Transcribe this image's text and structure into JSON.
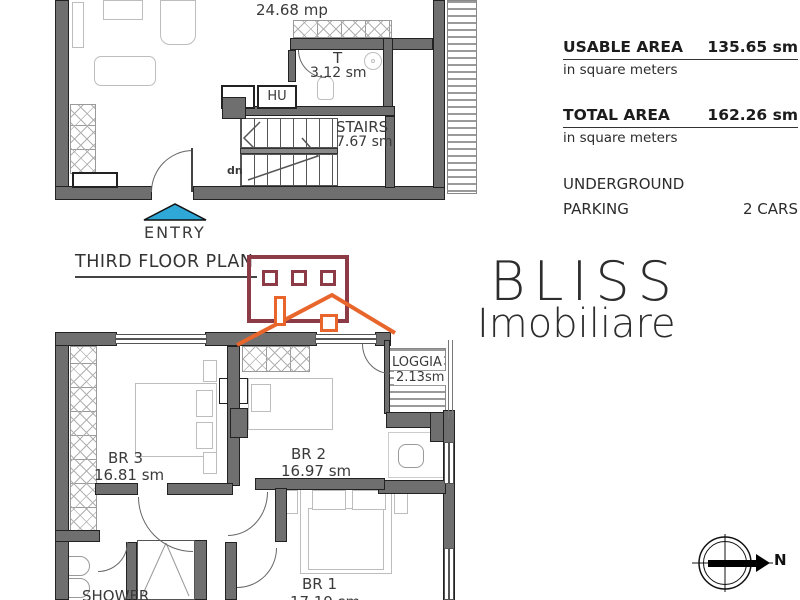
{
  "plan_title": "THIRD FLOOR PLAN",
  "info_panel": {
    "usable_area": {
      "label": "USABLE AREA",
      "value": "135.65 sm",
      "unit_note": "in square meters"
    },
    "total_area": {
      "label": "TOTAL AREA",
      "value": "162.26 sm",
      "unit_note": "in square meters"
    },
    "parking": {
      "label_line1": "UNDERGROUND",
      "label_line2": "PARKING",
      "value": "2 CARS"
    }
  },
  "upper_plan": {
    "living_area_label": "24.68 mp",
    "toilet_label": "T",
    "toilet_area": "3.12 sm",
    "hu_label": "HU",
    "stairs_label": "STAIRS",
    "stairs_area": "7.67 sm",
    "down_label": "dn",
    "entry_label": "ENTRY"
  },
  "lower_plan": {
    "loggia_label": "LOGGIA",
    "loggia_area": "2.13sm",
    "br3_label": "BR 3",
    "br3_area": "16.81 sm",
    "br2_label": "BR 2",
    "br2_area": "16.97 sm",
    "br1_label": "BR 1",
    "br1_area": "17.19 sm",
    "shower_label": "SHOWER"
  },
  "logo": {
    "brand": "BLISS",
    "brand_sub": "Imobiliare"
  },
  "compass": {
    "north_label": "N"
  },
  "colors": {
    "wall_gray": "#6f6f6f",
    "entry_arrow_blue": "#2fa8d8",
    "logo_maroon": "#8c3b47",
    "logo_orange": "#e8662b"
  }
}
